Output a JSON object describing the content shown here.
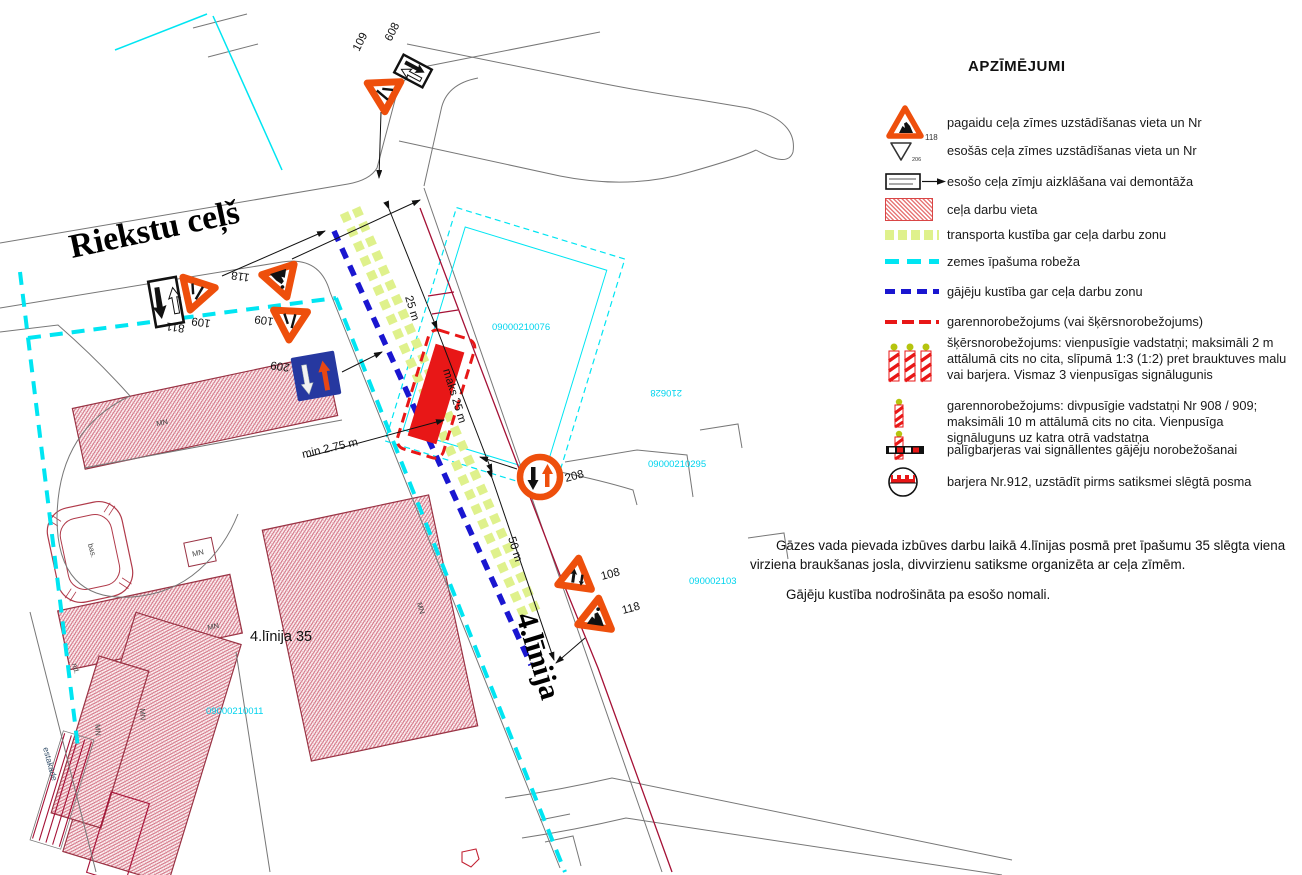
{
  "legend": {
    "title": "APZĪMĒJUMI",
    "items": [
      {
        "sign_nr": "118",
        "icon": "temporary-sign-triangle",
        "label": "pagaidu ceļa zīmes uzstādīšanas vieta un Nr"
      },
      {
        "sign_nr": "206",
        "icon": "existing-sign-triangle",
        "label": "esošās ceļa zīmes uzstādīšanas vieta un Nr"
      },
      {
        "icon": "covered-sign-with-arrow",
        "label": "esošo ceļa zīmju aizklāšana vai demontāža"
      },
      {
        "icon": "red-hatched-area",
        "label": "ceļa darbu vieta"
      },
      {
        "icon": "green-dash-strip",
        "label": "transporta kustība gar ceļa darbu zonu"
      },
      {
        "icon": "cyan-dash-line",
        "label": "zemes īpašuma robeža"
      },
      {
        "icon": "blue-dash-line",
        "label": "gājēju kustība gar ceļa darbu zonu"
      },
      {
        "icon": "red-dash-line",
        "label": "garennorobežojums (vai šķērsnorobežojums)"
      },
      {
        "icon": "three-striped-posts",
        "label": "šķērsnorobežojums: vienpusīgie vadstatņi; maksimāli 2 m attālumā cits no cita, slīpumā 1:3 (1:2) pret brauktuves malu vai barjera. Vismaz 3 vienpusīgas signālugunis"
      },
      {
        "icon": "two-striped-posts",
        "label": "garennorobežojums: divpusīgie vadstatņi Nr 908 / 909; maksimāli 10 m attālumā cits no cita. Vienpusīga signāluguns uz katra otrā vadstatņa"
      },
      {
        "icon": "aux-barrier-bar",
        "label": "palīgbarjeras vai signāllentes gājēju norobežošanai"
      },
      {
        "icon": "barrier-912-circle",
        "label": "barjera Nr.912, uzstādīt pirms satiksmei slēgtā posma"
      }
    ]
  },
  "notes": {
    "p1": "Gāzes vada pievada izbūves darbu laikā 4.līnijas posmā pret īpašumu 35 slēgta viena virziena braukšanas josla, divvirzienu satiksme organizēta ar ceļa zīmēm.",
    "p2": "Gājēju kustība nodrošināta pa esošo nomali."
  },
  "map": {
    "streets": {
      "riekstu": "Riekstu ceļš",
      "linija4": "4.līnija"
    },
    "property": "4.līnija 35",
    "signs": {
      "s109": "109",
      "s608": "608",
      "s811": "811",
      "s118": "118",
      "s209": "209",
      "s208": "208",
      "s108": "108"
    },
    "dims": {
      "d25": "25 m",
      "dmaks25": "maks 25 m",
      "dmin": "min 2.75 m",
      "d50": "50 m"
    },
    "parcels": {
      "p076": "09000210076",
      "p295": "09000210295",
      "p103": "090002103",
      "p011": "09000210011",
      "p628": "210628"
    },
    "labels": {
      "mn": "MN",
      "bas": "bas.",
      "nd": "nd.",
      "estakade": "estakāde"
    }
  },
  "colors": {
    "sign_orange": "#EE4F0C",
    "sign_blue": "#2638A0",
    "work_red": "#E81717",
    "traffic_green": "#DFF18C",
    "boundary_cyan": "#00E5F2",
    "pedestrian_blue": "#1A16D0",
    "barrier_maroon": "#A51136",
    "building_hatch_pink": "#CC6077"
  }
}
